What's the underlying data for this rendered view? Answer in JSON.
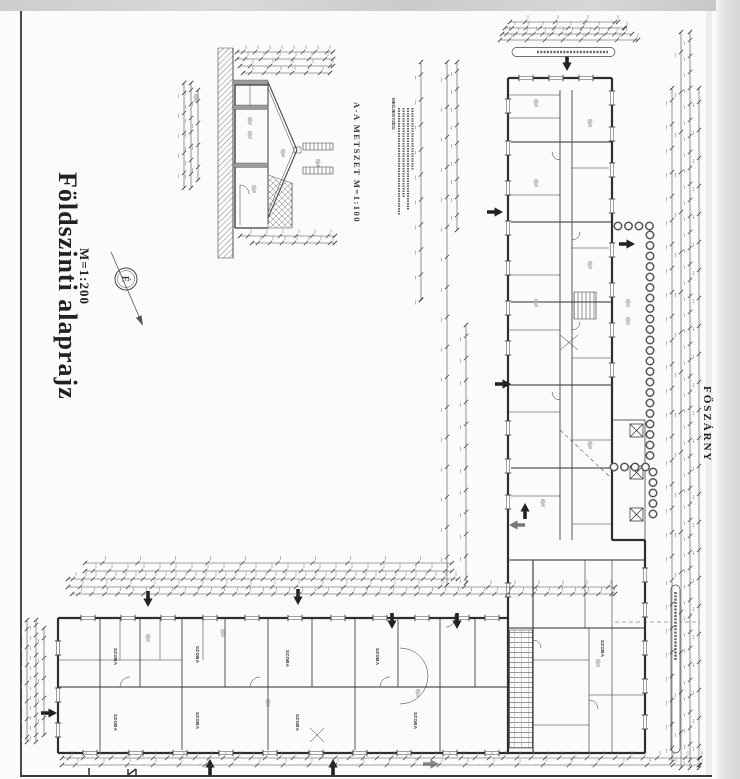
{
  "document": {
    "title": "Földszinti alaprajz",
    "scale": "M=1:200"
  },
  "section_detail": {
    "label": "A-A METSZET  M=1:100"
  },
  "notes": {
    "heading": "MEGJEGYZÉS:"
  },
  "compass": {
    "north_letter": "É"
  },
  "wing": {
    "name": "FŐSZÁRNY"
  },
  "rooms": {
    "generic_label": "SZOBA"
  },
  "colors": {
    "ink": "#3a3a3a",
    "paper": "#fbfbf9",
    "scan_band": "#d6d5d3",
    "hedge": "#555555"
  }
}
